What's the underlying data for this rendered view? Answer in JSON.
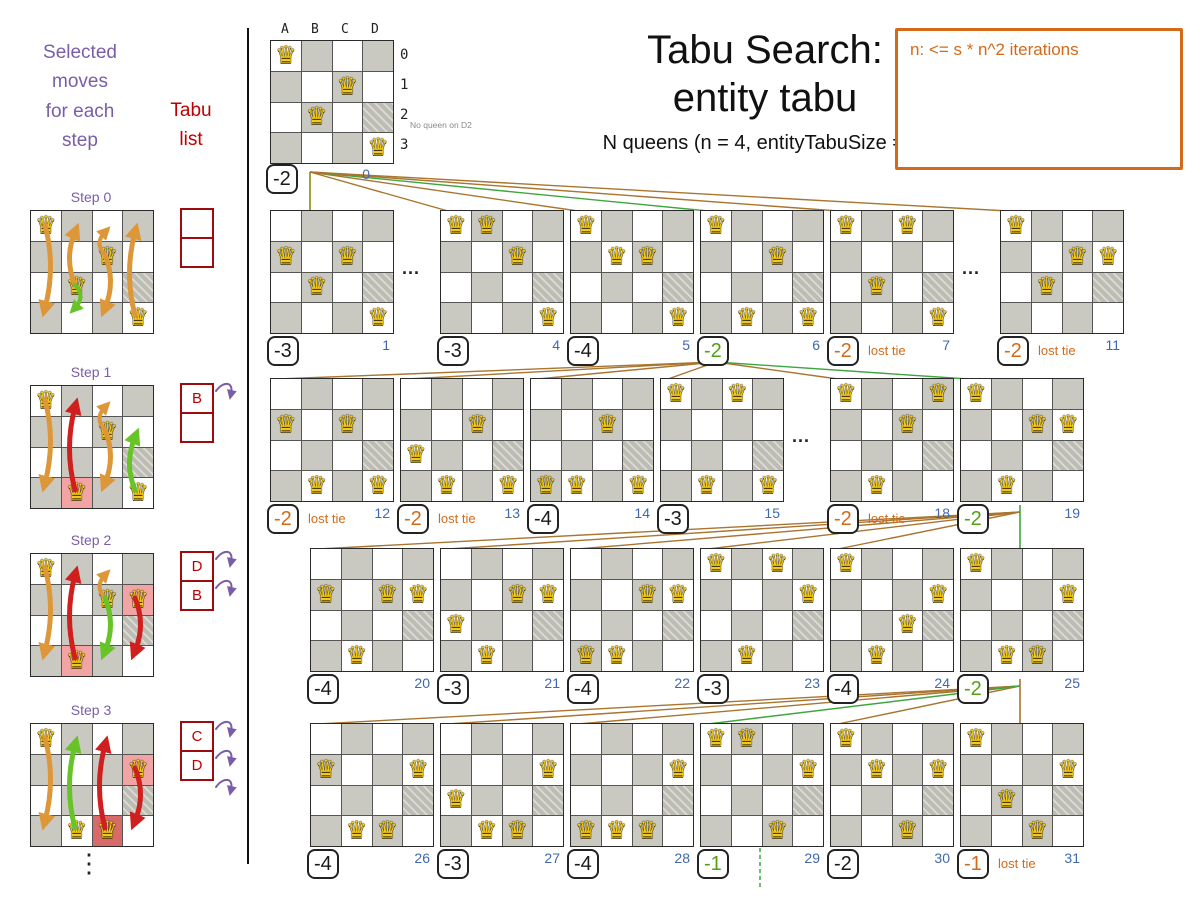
{
  "header": {
    "title_line1": "Tabu Search:",
    "title_line2": "entity tabu",
    "subtitle": "N queens (n = 4, entityTabuSize = 2)",
    "note_box": "n: <= s * n^2 iterations"
  },
  "left_panel": {
    "moves_header": "Selected\nmoves\nfor each\nstep",
    "tabu_header": "Tabu\nlist",
    "ellipsis": "⋮"
  },
  "dots_label": "...",
  "steps": [
    {
      "label": "Step 0",
      "queens": [
        "A0",
        "C1",
        "B2",
        "D3"
      ],
      "highlights": {},
      "tabu": [
        "",
        ""
      ],
      "curls": 0,
      "arrows": [
        {
          "col": "A",
          "from": 0,
          "to": 3,
          "color": "orange"
        },
        {
          "col": "B",
          "from": 2,
          "to": 0,
          "color": "orange"
        },
        {
          "col": "B",
          "from": 2,
          "to": 3,
          "color": "green"
        },
        {
          "col": "C",
          "from": 1,
          "to": 0,
          "color": "orange"
        },
        {
          "col": "C",
          "from": 1,
          "to": 3,
          "color": "orange"
        },
        {
          "col": "D",
          "from": 3,
          "to": 0,
          "color": "orange"
        }
      ]
    },
    {
      "label": "Step 1",
      "queens": [
        "A0",
        "C1",
        "B3",
        "D3"
      ],
      "highlights": {
        "B3": "pink"
      },
      "tabu": [
        "B",
        ""
      ],
      "curls": 1,
      "arrows": [
        {
          "col": "A",
          "from": 0,
          "to": 3,
          "color": "orange"
        },
        {
          "col": "B",
          "from": 3,
          "to": 0,
          "color": "red"
        },
        {
          "col": "C",
          "from": 1,
          "to": 0,
          "color": "orange"
        },
        {
          "col": "C",
          "from": 1,
          "to": 3,
          "color": "orange"
        },
        {
          "col": "D",
          "from": 3,
          "to": 1,
          "color": "green"
        }
      ]
    },
    {
      "label": "Step 2",
      "queens": [
        "A0",
        "C1",
        "D1",
        "B3"
      ],
      "highlights": {
        "B3": "pink",
        "D1": "pink"
      },
      "tabu": [
        "D",
        "B"
      ],
      "curls": 2,
      "arrows": [
        {
          "col": "A",
          "from": 0,
          "to": 3,
          "color": "orange"
        },
        {
          "col": "B",
          "from": 3,
          "to": 0,
          "color": "red"
        },
        {
          "col": "C",
          "from": 1,
          "to": 0,
          "color": "orange"
        },
        {
          "col": "C",
          "from": 1,
          "to": 3,
          "color": "green"
        },
        {
          "col": "D",
          "from": 1,
          "to": 3,
          "color": "red"
        }
      ]
    },
    {
      "label": "Step 3",
      "queens": [
        "A0",
        "D1",
        "B3",
        "C3"
      ],
      "highlights": {
        "D1": "pink",
        "C3": "redcell"
      },
      "tabu": [
        "C",
        "D"
      ],
      "curls": 3,
      "arrows": [
        {
          "col": "A",
          "from": 0,
          "to": 3,
          "color": "orange"
        },
        {
          "col": "B",
          "from": 3,
          "to": 0,
          "color": "green"
        },
        {
          "col": "C",
          "from": 3,
          "to": 0,
          "color": "red"
        },
        {
          "col": "D",
          "from": 1,
          "to": 3,
          "color": "red"
        }
      ]
    }
  ],
  "root": {
    "column_labels": [
      "A",
      "B",
      "C",
      "D"
    ],
    "row_labels": [
      "0",
      "1",
      "2",
      "3"
    ],
    "queens": [
      "A0",
      "C1",
      "B2",
      "D3"
    ],
    "annotation": "No queen on D2",
    "score": "-2",
    "iteration": "0"
  },
  "rows": [
    [
      {
        "iter": "1",
        "score": "-3",
        "tone": "black",
        "note": "",
        "queens": [
          "A1",
          "C1",
          "B2",
          "D3"
        ]
      },
      {
        "dots": true
      },
      {
        "iter": "4",
        "score": "-3",
        "tone": "black",
        "note": "",
        "queens": [
          "A0",
          "B0",
          "C1",
          "D3"
        ]
      },
      {
        "iter": "5",
        "score": "-4",
        "tone": "black",
        "note": "",
        "queens": [
          "A0",
          "B1",
          "C1",
          "D3"
        ]
      },
      {
        "iter": "6",
        "score": "-2",
        "tone": "green",
        "note": "",
        "queens": [
          "A0",
          "B3",
          "C1",
          "D3"
        ],
        "selected": true
      },
      {
        "iter": "7",
        "score": "-2",
        "tone": "orange",
        "note": "lost tie",
        "queens": [
          "A0",
          "B2",
          "C0",
          "D3"
        ]
      },
      {
        "dots": true
      },
      {
        "iter": "11",
        "score": "-2",
        "tone": "orange",
        "note": "lost tie",
        "queens": [
          "A0",
          "B2",
          "C1",
          "D1"
        ]
      }
    ],
    [
      {
        "iter": "12",
        "score": "-2",
        "tone": "orange",
        "note": "lost tie",
        "queens": [
          "A1",
          "B3",
          "C1",
          "D3"
        ]
      },
      {
        "iter": "13",
        "score": "-2",
        "tone": "orange",
        "note": "lost tie",
        "queens": [
          "A2",
          "B3",
          "C1",
          "D3"
        ]
      },
      {
        "iter": "14",
        "score": "-4",
        "tone": "black",
        "note": "",
        "queens": [
          "A3",
          "B3",
          "C1",
          "D3"
        ]
      },
      {
        "iter": "15",
        "score": "-3",
        "tone": "black",
        "note": "",
        "queens": [
          "A0",
          "B3",
          "C0",
          "D3"
        ]
      },
      {
        "dots": true
      },
      {
        "iter": "18",
        "score": "-2",
        "tone": "orange",
        "note": "lost tie",
        "queens": [
          "A0",
          "B3",
          "C1",
          "D0"
        ]
      },
      {
        "iter": "19",
        "score": "-2",
        "tone": "green",
        "note": "",
        "queens": [
          "A0",
          "B3",
          "C1",
          "D1"
        ],
        "selected": true
      }
    ],
    [
      {
        "iter": "20",
        "score": "-4",
        "tone": "black",
        "note": "",
        "queens": [
          "A1",
          "B3",
          "C1",
          "D1"
        ]
      },
      {
        "iter": "21",
        "score": "-3",
        "tone": "black",
        "note": "",
        "queens": [
          "A2",
          "B3",
          "C1",
          "D1"
        ]
      },
      {
        "iter": "22",
        "score": "-4",
        "tone": "black",
        "note": "",
        "queens": [
          "A3",
          "B3",
          "C1",
          "D1"
        ]
      },
      {
        "iter": "23",
        "score": "-3",
        "tone": "black",
        "note": "",
        "queens": [
          "A0",
          "B3",
          "C0",
          "D1"
        ]
      },
      {
        "iter": "24",
        "score": "-4",
        "tone": "black",
        "note": "",
        "queens": [
          "A0",
          "B3",
          "C2",
          "D1"
        ]
      },
      {
        "iter": "25",
        "score": "-2",
        "tone": "green",
        "note": "",
        "queens": [
          "A0",
          "B3",
          "C3",
          "D1"
        ],
        "selected": true
      }
    ],
    [
      {
        "iter": "26",
        "score": "-4",
        "tone": "black",
        "note": "",
        "queens": [
          "A1",
          "B3",
          "C3",
          "D1"
        ]
      },
      {
        "iter": "27",
        "score": "-3",
        "tone": "black",
        "note": "",
        "queens": [
          "A2",
          "B3",
          "C3",
          "D1"
        ]
      },
      {
        "iter": "28",
        "score": "-4",
        "tone": "black",
        "note": "",
        "queens": [
          "A3",
          "B3",
          "C3",
          "D1"
        ]
      },
      {
        "iter": "29",
        "score": "-1",
        "tone": "green",
        "note": "",
        "queens": [
          "A0",
          "B0",
          "C3",
          "D1"
        ],
        "selected": true
      },
      {
        "iter": "30",
        "score": "-2",
        "tone": "black",
        "note": "",
        "queens": [
          "A0",
          "B1",
          "C3",
          "D1"
        ]
      },
      {
        "iter": "31",
        "score": "-1",
        "tone": "orange",
        "note": "lost tie",
        "queens": [
          "A0",
          "B2",
          "C3",
          "D1"
        ]
      }
    ]
  ],
  "colors": {
    "accent_orange": "#d26a1a",
    "score_green": "#54a015",
    "iteration_blue": "#3f68b0",
    "tabu_red": "#c00000",
    "purple": "#7a5da8",
    "line_brown": "#a9752f",
    "line_green": "#3fa63f",
    "line_olive": "#8a8a00"
  }
}
